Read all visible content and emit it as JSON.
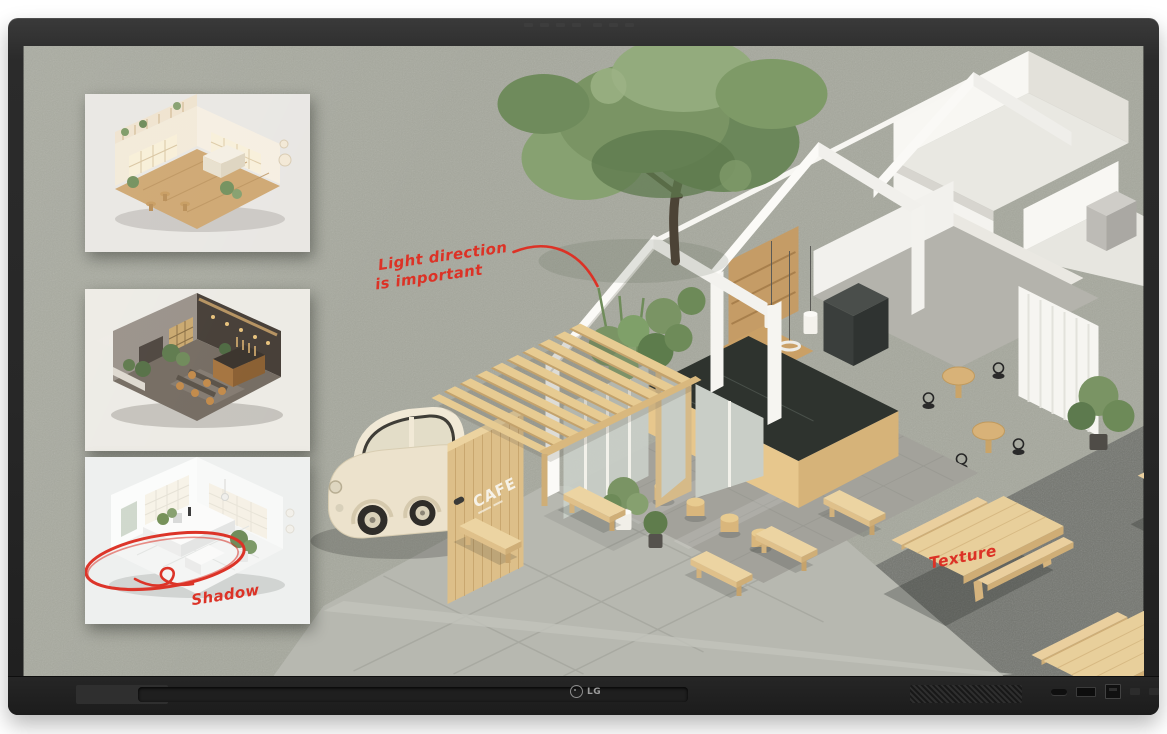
{
  "device": {
    "logo_text": "LG"
  },
  "palette": {
    "annotation-red": "#dc3226",
    "bezel": "#2a2a2a",
    "screen-concrete": "#a6a89d",
    "asphalt": "#73756f",
    "pavement": "#b7b8b0",
    "white-wall": "#f8f7f3",
    "wood-light": "#e8cf9b",
    "wood-mid": "#d9b87e",
    "counter-marble": "#2e332e",
    "foliage": "#7a9464",
    "car-cream": "#ece2cc"
  },
  "screen": {
    "cafe_sign": "CAFE",
    "annotations": {
      "light_direction": {
        "line1": "Light direction",
        "line2": "is important"
      },
      "texture": "Texture",
      "shadow": "Shadow"
    },
    "insets": [
      {
        "name": "warm-cafe-interior-render"
      },
      {
        "name": "dark-lounge-interior-render"
      },
      {
        "name": "white-kitchen-interior-render"
      }
    ]
  }
}
